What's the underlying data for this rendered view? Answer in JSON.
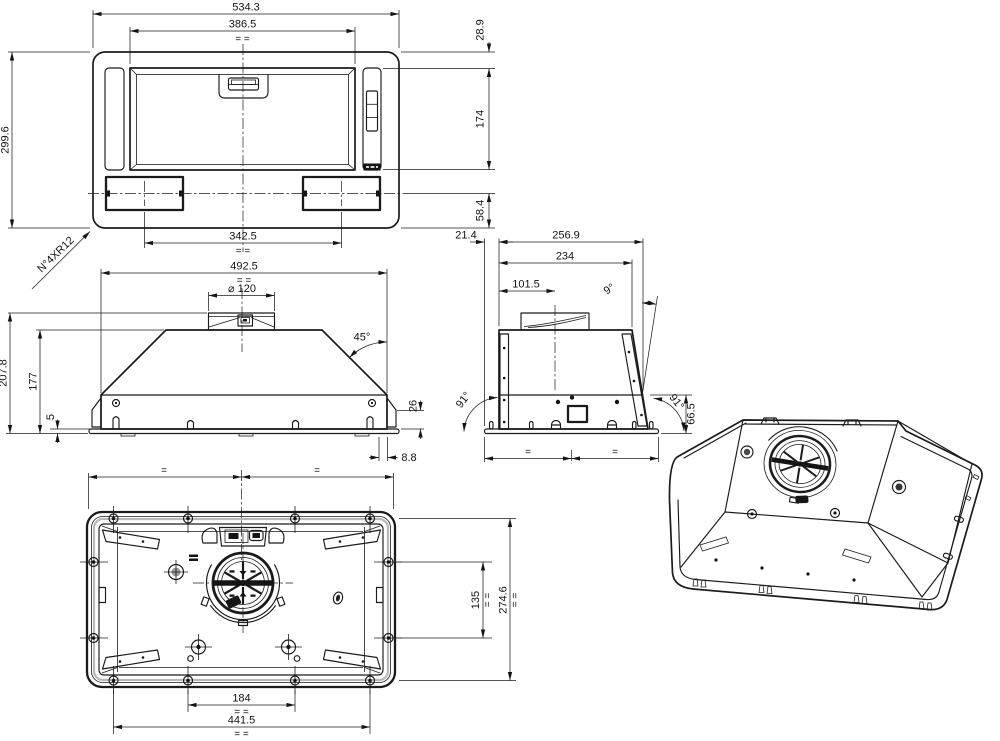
{
  "sym": {
    "pair": "= =",
    "single": "="
  },
  "front_view": {
    "overall_width": "534.3",
    "filter_width": "386.5",
    "overall_height": "299.6",
    "top_offset": "28.9",
    "filter_height": "174",
    "bottom_offset": "58.4",
    "lamp_spacing": "342.5",
    "corner_radius_note": "N°4XR12"
  },
  "elevation_view": {
    "body_width": "492.5",
    "duct_diameter": "⌀ 120",
    "canopy_angle": "45°",
    "total_height": "207.8",
    "body_height": "177",
    "flange_thickness": "5",
    "base_height": "26",
    "flange_overhang": "8.8"
  },
  "side_view": {
    "flange_offset": "21.4",
    "overall_depth": "256.9",
    "top_depth": "234",
    "duct_center_offset": "101.5",
    "back_tilt_angle": "9°",
    "flange_angle_left": "91°",
    "flange_angle_right": "91°",
    "base_height": "66.5"
  },
  "bottom_view": {
    "mount_hole_spacing_width": "184",
    "fixing_hole_spacing_width": "441.5",
    "mount_hole_spacing_depth": "135",
    "fixing_hole_spacing_depth": "274.6"
  }
}
